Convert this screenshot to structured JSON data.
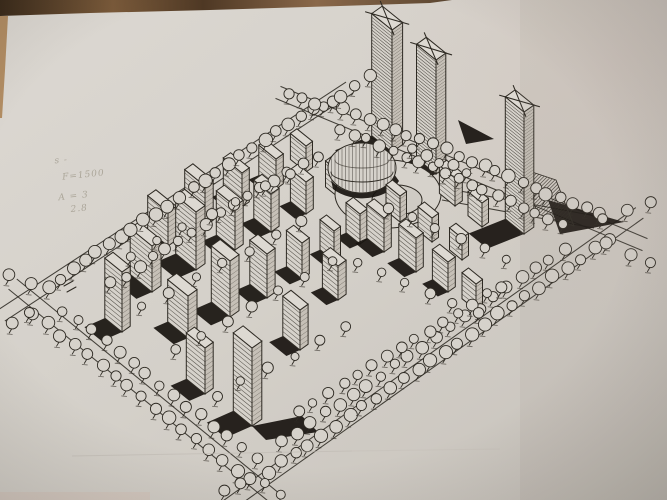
{
  "photo": {
    "paper_light": "#dcd8d2",
    "paper_mid": "#d4d0c9",
    "paper_dark": "#c7c2bb",
    "paper_fill": "#d6d2cb",
    "ink": "#2e2a23",
    "shadow_black": "#18140f",
    "table_wood_dark": "#3a2a1a",
    "table_wood_light": "#8a684a",
    "left_strip": "#b28d63",
    "pencil_gray": "#87806f"
  },
  "pencil_notes": {
    "lines": [
      "s -",
      "F=1500",
      "A = 3",
      "2.8"
    ],
    "pos": [
      [
        57,
        163
      ],
      [
        63,
        180
      ],
      [
        57,
        200
      ],
      [
        68,
        213
      ]
    ]
  },
  "drawing": {
    "site_corners": {
      "w": [
        40,
        298
      ],
      "n": [
        318,
        116
      ],
      "e": [
        600,
        233
      ],
      "s": [
        258,
        476
      ]
    },
    "edges": [
      [
        40,
        298,
        318,
        116,
        -0.548,
        -0.837,
        42
      ],
      [
        318,
        116,
        600,
        233,
        0.383,
        -0.924,
        46
      ],
      [
        40,
        298,
        258,
        476,
        -0.633,
        0.775,
        30
      ],
      [
        258,
        476,
        600,
        233,
        0.579,
        0.815,
        44
      ],
      [
        442,
        200,
        594,
        228,
        -0.18,
        -0.98,
        0
      ]
    ],
    "road_ticks": [
      [
        64,
        286,
        73,
        281
      ],
      [
        67,
        292,
        76,
        287
      ]
    ],
    "tree_rows": [
      [
        48,
        286,
        312,
        108,
        23,
        5
      ],
      [
        112,
        284,
        302,
        162,
        15,
        4.4
      ],
      [
        332,
        102,
        598,
        214,
        22,
        5
      ],
      [
        340,
        128,
        562,
        224,
        18,
        4.4
      ],
      [
        34,
        314,
        250,
        480,
        17,
        5
      ],
      [
        64,
        310,
        256,
        458,
        15,
        4.4
      ],
      [
        268,
        472,
        608,
        240,
        26,
        5
      ],
      [
        282,
        442,
        564,
        250,
        21,
        4.6
      ],
      [
        300,
        412,
        502,
        286,
        15,
        4.2
      ],
      [
        414,
        150,
        468,
        172,
        5,
        4.2
      ],
      [
        130,
        256,
        318,
        158,
        8,
        4
      ],
      [
        142,
        306,
        302,
        222,
        7,
        4
      ],
      [
        174,
        350,
        332,
        262,
        7,
        4
      ],
      [
        216,
        396,
        346,
        328,
        6,
        4
      ],
      [
        388,
        208,
        508,
        258,
        6,
        4
      ],
      [
        358,
        262,
        478,
        312,
        6,
        4
      ],
      [
        322,
        106,
        372,
        74,
        4,
        4.6
      ],
      [
        288,
        94,
        314,
        104,
        3,
        4.4
      ],
      [
        604,
        220,
        650,
        202,
        3,
        4.6
      ],
      [
        608,
        244,
        652,
        262,
        3,
        4.6
      ],
      [
        10,
        276,
        32,
        284,
        2,
        4.4
      ],
      [
        12,
        322,
        28,
        312,
        2,
        4.4
      ],
      [
        224,
        492,
        240,
        484,
        2,
        4.4
      ],
      [
        266,
        484,
        282,
        494,
        2,
        4.4
      ]
    ],
    "blocks": [
      [
        168,
        246,
        26,
        10,
        34
      ],
      [
        205,
        226,
        26,
        10,
        40
      ],
      [
        242,
        207,
        24,
        9,
        34
      ],
      [
        276,
        189,
        22,
        9,
        30
      ],
      [
        306,
        172,
        20,
        8,
        26
      ],
      [
        152,
        292,
        28,
        11,
        46
      ],
      [
        196,
        270,
        26,
        11,
        58
      ],
      [
        235,
        250,
        24,
        10,
        44
      ],
      [
        271,
        232,
        22,
        10,
        38
      ],
      [
        306,
        214,
        20,
        9,
        32
      ],
      [
        338,
        197,
        16,
        8,
        26
      ],
      [
        188,
        338,
        26,
        11,
        42
      ],
      [
        230,
        317,
        24,
        11,
        56
      ],
      [
        267,
        298,
        22,
        10,
        44
      ],
      [
        302,
        279,
        20,
        9,
        36
      ],
      [
        334,
        261,
        18,
        8,
        30
      ],
      [
        122,
        332,
        22,
        10,
        60
      ],
      [
        205,
        394,
        24,
        10,
        46
      ],
      [
        252,
        426,
        24,
        12,
        78
      ],
      [
        300,
        350,
        22,
        10,
        40
      ],
      [
        338,
        300,
        20,
        10,
        34
      ],
      [
        360,
        244,
        18,
        9,
        30
      ],
      [
        455,
        206,
        20,
        9,
        28
      ],
      [
        482,
        227,
        18,
        8,
        24
      ],
      [
        400,
        222,
        18,
        8,
        26
      ],
      [
        432,
        242,
        18,
        8,
        24
      ],
      [
        462,
        260,
        16,
        8,
        22
      ],
      [
        384,
        252,
        22,
        9,
        34
      ],
      [
        416,
        272,
        22,
        9,
        34
      ],
      [
        448,
        292,
        20,
        9,
        30
      ],
      [
        476,
        310,
        18,
        8,
        26
      ]
    ],
    "towers": [
      [
        392,
        152,
        26,
        13,
        122
      ],
      [
        436,
        174,
        25,
        12,
        114
      ],
      [
        524,
        234,
        24,
        12,
        122
      ]
    ],
    "dome": {
      "cx": 362,
      "cy": 168,
      "rx": 34,
      "ry": 25
    },
    "ring_outer": {
      "cx": 388,
      "cy": 194,
      "rx": 53,
      "ry": 34
    },
    "ring_inner": {
      "cx": 397,
      "cy": 200,
      "rx": 25,
      "ry": 15
    },
    "dark_polys": [
      [
        [
          548,
          200
        ],
        [
          624,
          222
        ],
        [
          560,
          234
        ]
      ],
      [
        [
          458,
          120
        ],
        [
          494,
          139
        ],
        [
          466,
          144
        ]
      ],
      [
        [
          252,
          426
        ],
        [
          302,
          416
        ],
        [
          318,
          432
        ],
        [
          266,
          440
        ]
      ],
      [
        [
          428,
          178
        ],
        [
          452,
          190
        ],
        [
          432,
          197
        ]
      ]
    ],
    "hatch_polys": [
      [
        [
          520,
          168
        ],
        [
          556,
          180
        ],
        [
          574,
          226
        ],
        [
          538,
          214
        ]
      ],
      [
        [
          344,
          150
        ],
        [
          386,
          162
        ],
        [
          380,
          178
        ],
        [
          338,
          166
        ]
      ]
    ]
  }
}
